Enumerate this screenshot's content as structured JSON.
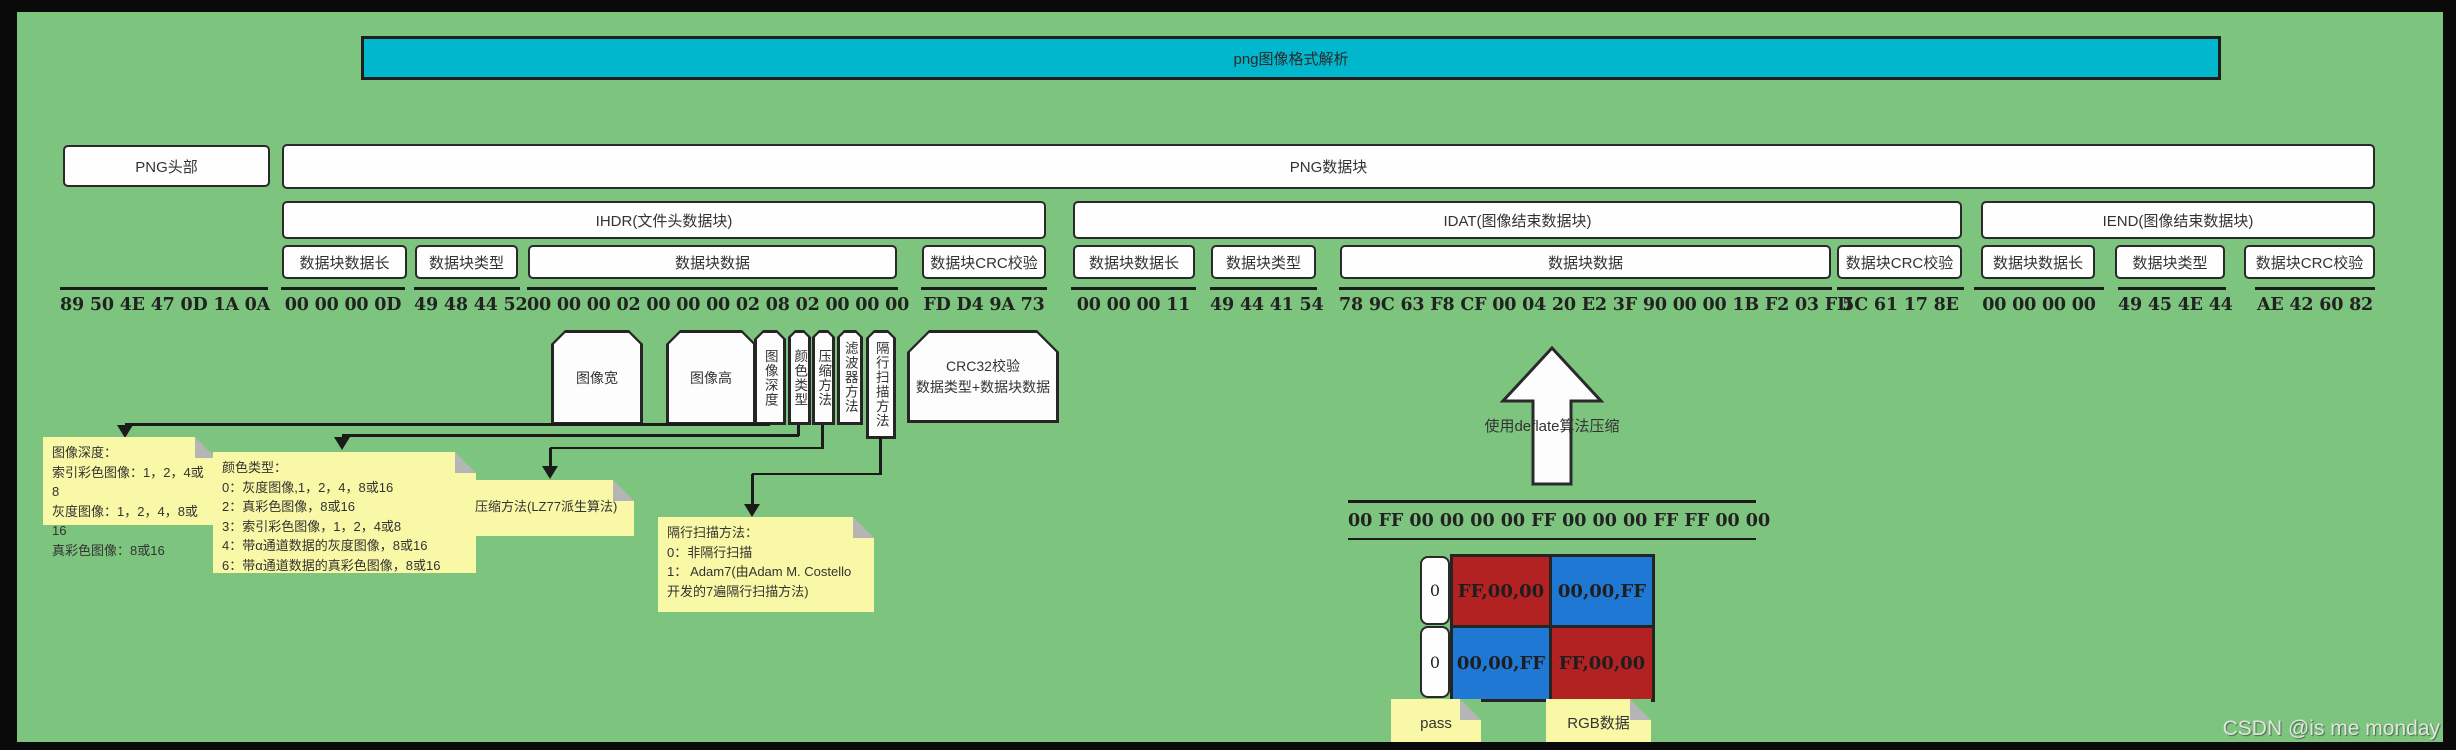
{
  "title": "png图像格式解析",
  "watermark": "CSDN @is me monday",
  "top_row": {
    "png_header_label": "PNG头部",
    "png_chunks_label": "PNG数据块",
    "png_header_hex": "89 50 4E 47 0D 1A 0A"
  },
  "chunk_labels": {
    "length": "数据块数据长",
    "type": "数据块类型",
    "data": "数据块数据",
    "crc": "数据块CRC校验"
  },
  "ihdr": {
    "title": "IHDR(文件头数据块)",
    "length_hex": "00 00 00 0D",
    "type_hex": "49 48 44 52",
    "data_hex": "00 00 00 02 00 00 00 02 08 02 00 00 00",
    "crc_hex": "FD D4 9A 73"
  },
  "idat": {
    "title": "IDAT(图像结束数据块)",
    "length_hex": "00 00 00 11",
    "type_hex": "49 44 41 54",
    "data_hex": "78 9C 63 F8 CF 00 04 20 E2 3F 90 00 00 1B F2 03 FD",
    "crc_hex": "5C 61 17 8E"
  },
  "iend": {
    "title": "IEND(图像结束数据块)",
    "length_hex": "00 00 00 00",
    "type_hex": "49 45 4E 44",
    "crc_hex": "AE 42 60 82"
  },
  "ihdr_data_fields": {
    "width": "图像宽",
    "height": "图像高",
    "bit_depth": "图像深度",
    "color_type": "颜色类型",
    "compression": "压缩方法",
    "filter": "滤波器方法",
    "interlace": "隔行扫描方法",
    "crc_line1": "CRC32校验",
    "crc_line2": "数据类型+数据块数据"
  },
  "notes": {
    "bit_depth": [
      "图像深度：",
      "索引彩色图像：1，2，4或8",
      "灰度图像：1，2，4，8或16",
      "真彩色图像：8或16"
    ],
    "color_type": [
      "颜色类型：",
      "0：灰度图像,1，2，4，8或16",
      "2：真彩色图像，8或16",
      "3：索引彩色图像，1，2，4或8",
      "4：带α通道数据的灰度图像，8或16",
      "6：带α通道数据的真彩色图像，8或16"
    ],
    "compression": [
      "压缩方法(LZ77派生算法)"
    ],
    "interlace": [
      "隔行扫描方法：",
      "0：非隔行扫描",
      "1：  Adam7(由Adam M. Costello",
      "开发的7遍隔行扫描方法)"
    ],
    "pass": "pass",
    "rgb": "RGB数据"
  },
  "idat_decoded": {
    "arrow_label": "使用deflate算法压缩",
    "raw_hex": "00 FF 00 00 00 00 FF 00 00 00 FF FF 00 00",
    "rows": [
      {
        "filter_byte": "0",
        "cells": [
          {
            "label": "FF,00,00",
            "color": "#b22222"
          },
          {
            "label": "00,00,FF",
            "color": "#1e78d4"
          }
        ]
      },
      {
        "filter_byte": "0",
        "cells": [
          {
            "label": "00,00,FF",
            "color": "#1e78d4"
          },
          {
            "label": "FF,00,00",
            "color": "#b22222"
          }
        ]
      }
    ]
  },
  "colors": {
    "canvas_bg": "#7dc47e",
    "title_bg": "#00b7ce",
    "note_bg": "#f8f8a6",
    "pixel_red": "#b22222",
    "pixel_blue": "#1e78d4"
  }
}
